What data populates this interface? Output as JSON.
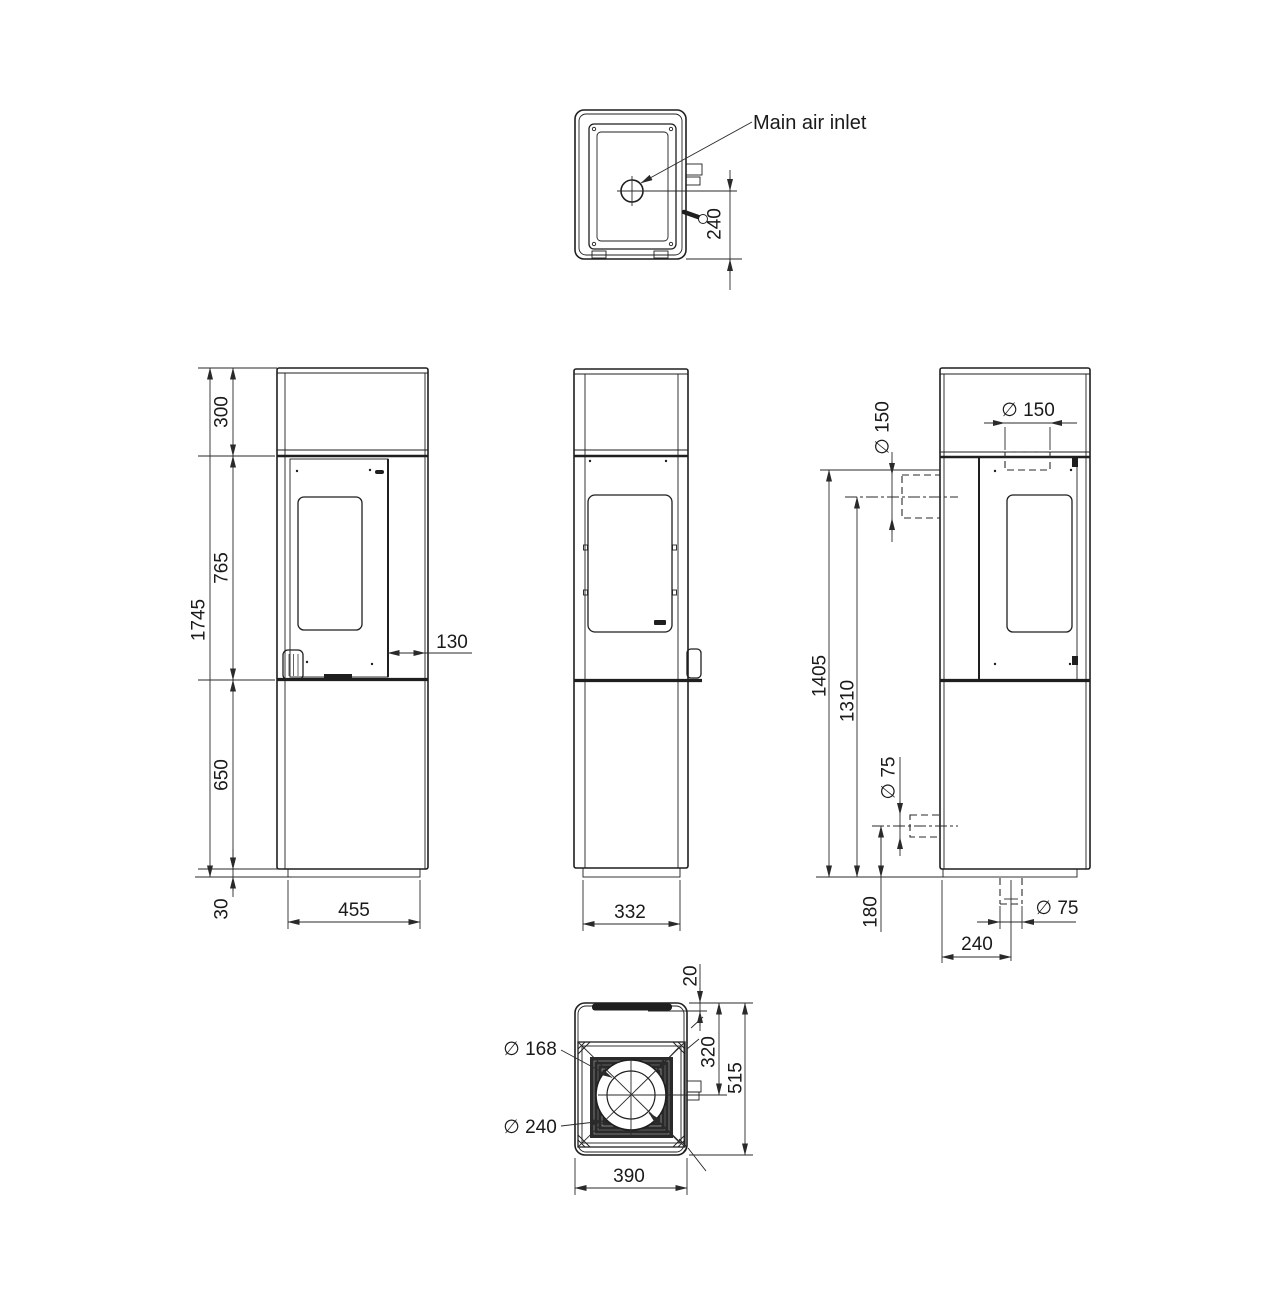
{
  "labels": {
    "main_air_inlet": "Main air inlet"
  },
  "dims": {
    "plan_bottom": {
      "inlet_to_front": "240"
    },
    "front": {
      "overall_height": "1745",
      "top_section": "300",
      "middle_section": "765",
      "lower_section": "650",
      "plinth_height": "30",
      "base_width": "455",
      "side_clearance": "130"
    },
    "side": {
      "base_depth": "332"
    },
    "rear": {
      "top_flue_dia": "∅ 150",
      "rear_flue_dia": "∅ 150",
      "top_flue_height": "1405",
      "rear_flue_height": "1310",
      "rear_air_dia": "∅ 75",
      "rear_air_height": "180",
      "bottom_air_dia": "∅ 75",
      "bottom_air_offset": "240"
    },
    "top_plate": {
      "rear_recess": "20",
      "flue_center_from_rear": "320",
      "overall_depth": "515",
      "flue_inner_dia": "∅ 168",
      "flue_outer_dia": "∅ 240",
      "overall_width": "390"
    }
  },
  "colors": {
    "line": "#1f1f1f",
    "dim": "#2a2a2a",
    "background": "#ffffff"
  }
}
